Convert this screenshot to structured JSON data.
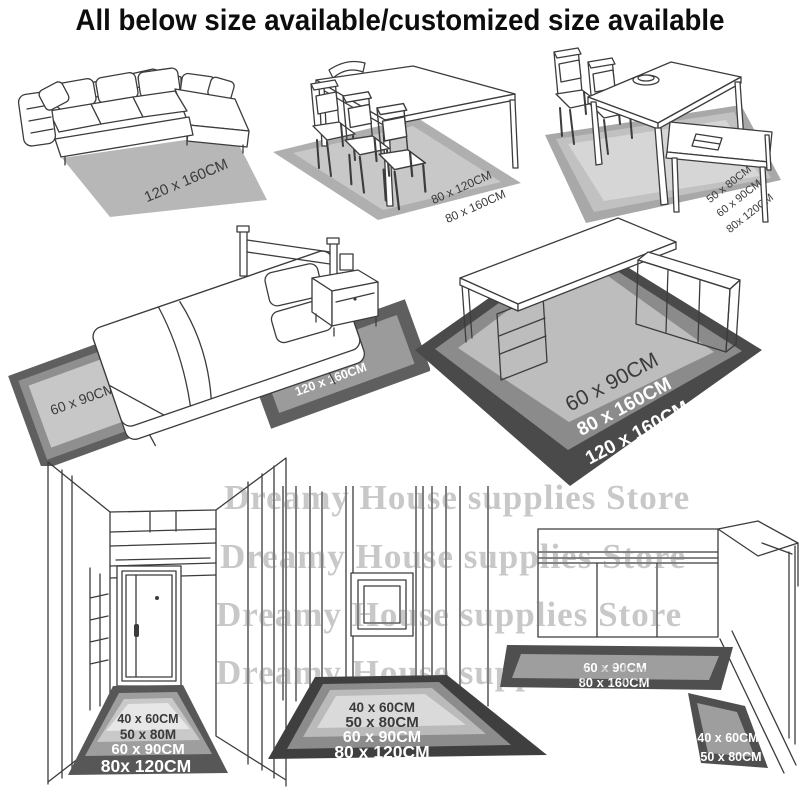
{
  "title": "All below size available/customized size available",
  "watermark": {
    "text": "Dreamy House supplies Store",
    "color": "#c8c8c8",
    "rows": 4
  },
  "palette": {
    "background": "#ffffff",
    "title_text": "#0d0d0d",
    "line_art": "#3c3c3c",
    "rug_darkest": "#3f3f3f",
    "rug_dark": "#575757",
    "rug_mid": "#8f8f8f",
    "rug_light": "#b9b9b9",
    "rug_lighter": "#c9c9c9",
    "rug_lightest": "#e7e7e7",
    "label_dark": "#3a3a3a",
    "label_white": "#ffffff"
  },
  "scenes": {
    "sofa": {
      "name": "corner-sofa-with-rug",
      "rug_labels": [
        "120 x 160CM"
      ]
    },
    "dining_table": {
      "name": "dining-table-three-chairs-with-rug",
      "rug_labels": [
        "80 x 120CM",
        "80 x 160CM"
      ]
    },
    "dining_bench": {
      "name": "dining-table-bench-with-rug",
      "rug_labels": [
        "50 x 80CM",
        "60 x 90CM",
        "80x 120CM"
      ]
    },
    "bedroom": {
      "name": "bed-nightstand-with-two-rugs",
      "left_rug_labels": [
        "60 x 90CM",
        "80x 120CM",
        "80x 160CM"
      ],
      "right_rug_labels": [
        "80 x 160CM",
        "120 x 160CM"
      ]
    },
    "desk": {
      "name": "l-shaped-desk-with-rug",
      "rug_labels": [
        "60 x 90CM",
        "80 x 160CM",
        "120 x 160CM"
      ]
    },
    "hallway": {
      "name": "entry-hallway-with-door-runner-rug",
      "rug_labels": [
        "40 x 60CM",
        "50 x 80M",
        "60 x 90CM",
        "80x 120CM"
      ]
    },
    "corridor": {
      "name": "corridor-with-frame-runner-rug",
      "rug_labels": [
        "40 x 60CM",
        "50 x 80CM",
        "60 x 90CM",
        "80 x 120CM"
      ]
    },
    "kitchen": {
      "name": "kitchen-counter-with-two-rugs",
      "long_rug_labels": [
        "60 x 90CM",
        "80 x 160CM"
      ],
      "small_rug_labels": [
        "40 x 60CM",
        "50 x 80CM"
      ]
    }
  }
}
